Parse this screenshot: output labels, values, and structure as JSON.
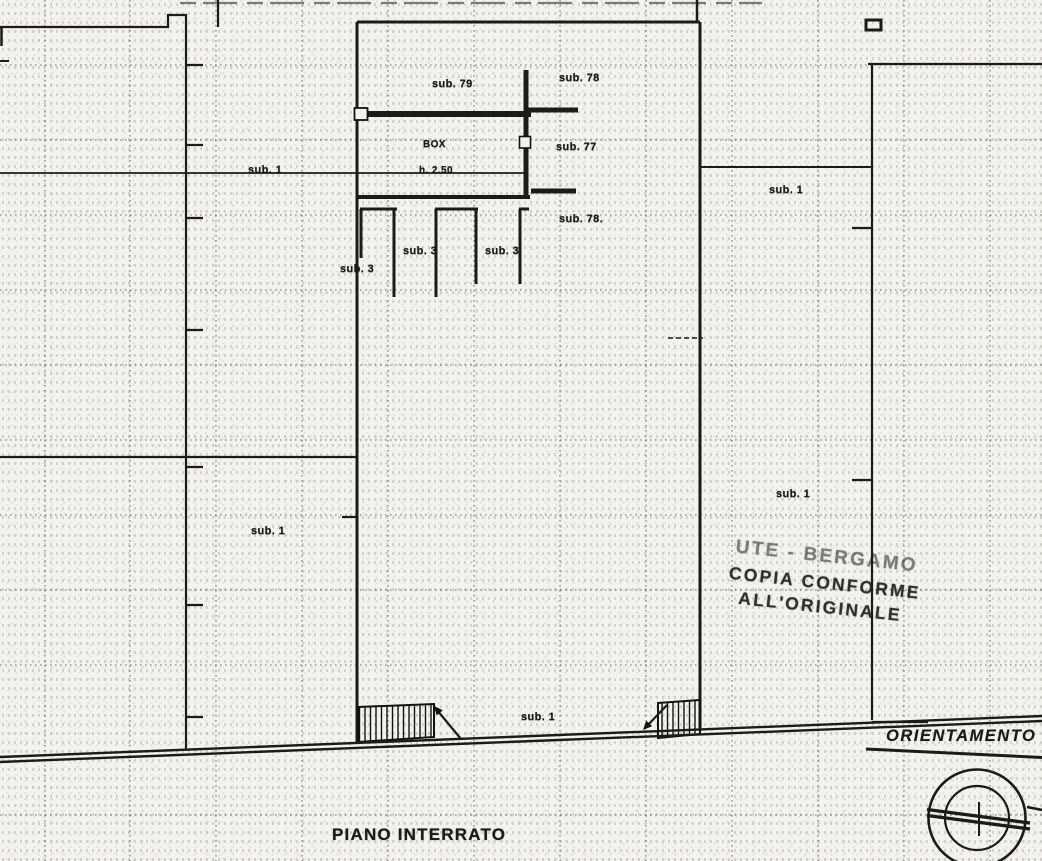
{
  "plan": {
    "floor_title": "PIANO INTERRATO",
    "orientation_label": "ORIENTAMENTO",
    "labels": {
      "sub79": "sub. 79",
      "sub78_top": "sub. 78",
      "box": "BOX",
      "box_height": "h. 2.50",
      "sub77": "sub. 77",
      "sub1_left_upper": "sub. 1",
      "sub1_right_upper": "sub. 1",
      "sub78_mid": "sub. 78.",
      "sub3_stall1": "sub. 3",
      "sub3_stall2": "sub. 3",
      "sub3_outer": "sub. 3",
      "sub1_right_mid": "sub. 1",
      "sub1_left_mid": "sub. 1",
      "sub1_bottom": "sub. 1"
    },
    "stamp": {
      "line1": "UTE - BERGAMO",
      "line2": "COPIA CONFORME",
      "line3": "ALL'ORIGINALE"
    },
    "colors": {
      "ink": "#1c1b18",
      "paper": "#f4f2ec"
    }
  }
}
